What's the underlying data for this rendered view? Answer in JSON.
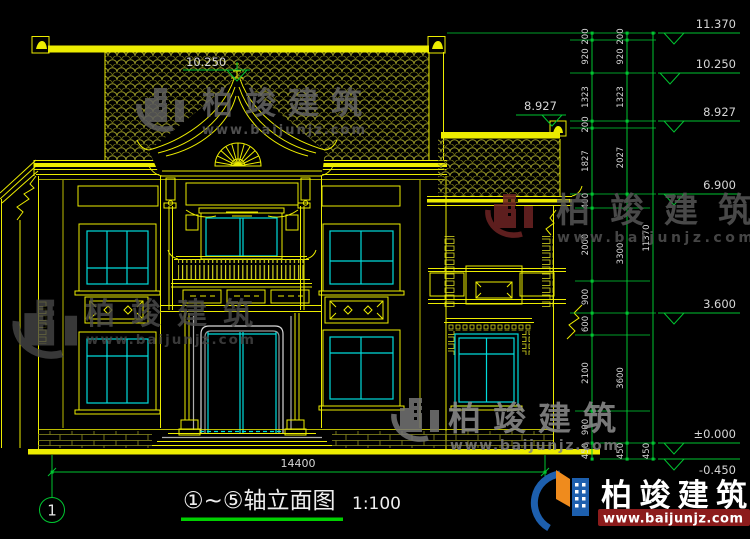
{
  "drawing": {
    "title": "①~⑤轴立面图",
    "scale": "1:100",
    "axis_bubble": "1",
    "overall_width": "14400",
    "roof_center_level": "10.250",
    "wing_ridge_level": "8.927"
  },
  "levels": {
    "l11370": "11.370",
    "l10250": "10.250",
    "l8927": "8.927",
    "l6900": "6.900",
    "l3600": "3.600",
    "l0": "±0.000",
    "lm450": "-0.450"
  },
  "chain_inner": [
    "200",
    "920",
    "1323",
    "200",
    "1827",
    "400",
    "2000",
    "900",
    "600",
    "2100",
    "900",
    "450"
  ],
  "chain_middle": [
    "200",
    "920",
    "1323",
    "2027",
    "3300",
    "3600",
    "450"
  ],
  "chain_outer": [
    "11370",
    "450"
  ],
  "watermark": {
    "name": "柏竣建筑",
    "url": "www.baijunjz.com"
  },
  "colors": {
    "line_yellow": "#ecec00",
    "line_cyan": "#00dcdc",
    "dim_green": "#00c531",
    "text_white": "#d6d6d6",
    "wm_red": "#8c1c1c",
    "logo_blue": "#1d5fae",
    "logo_orange": "#ef8b1d"
  }
}
